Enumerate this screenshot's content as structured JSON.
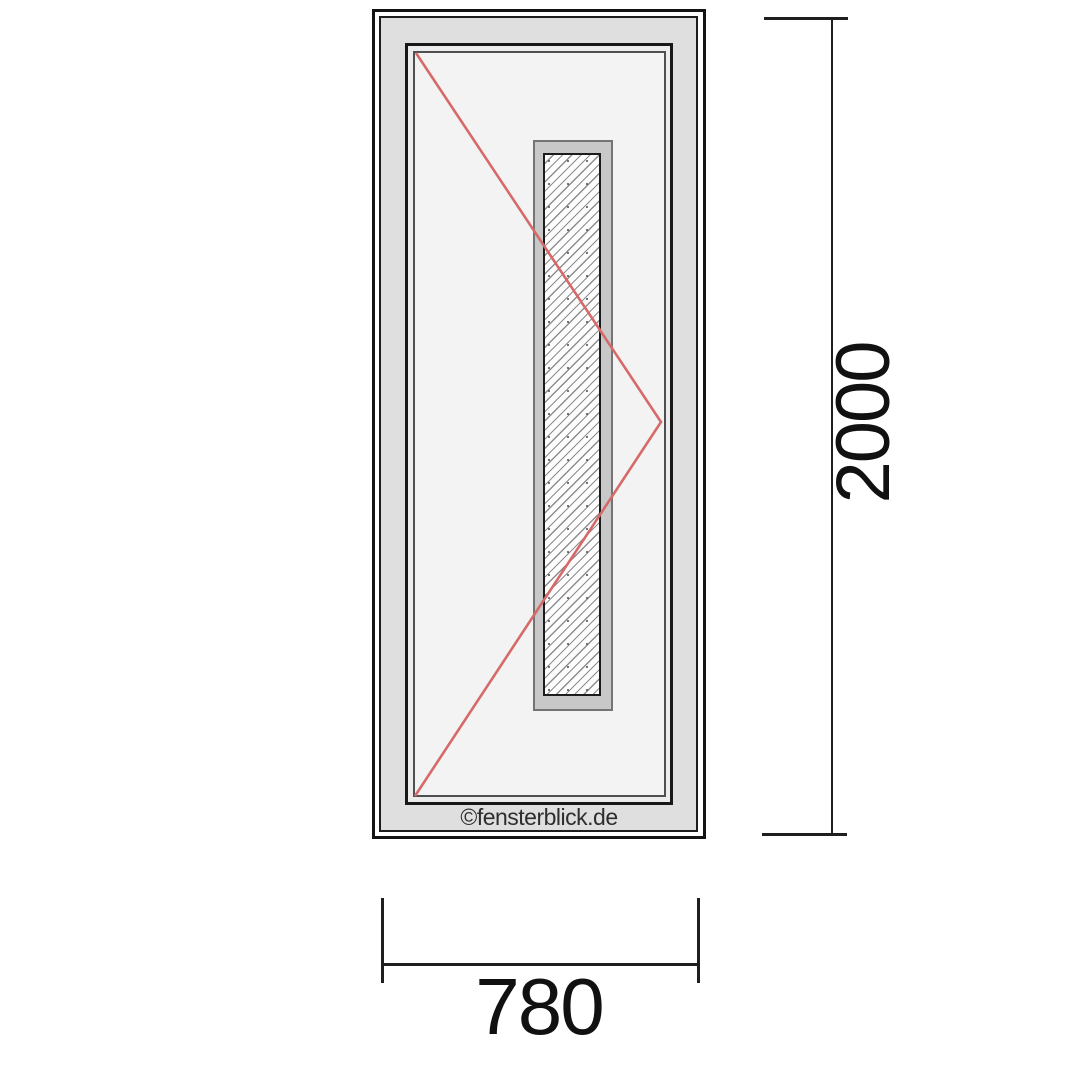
{
  "diagram": {
    "kind": "door-elevation-technical-drawing",
    "watermark": "©fensterblick.de",
    "opening_line_color": "#d66a6a",
    "glass_panel": "vertical-hatched-glazing"
  },
  "dimensions": {
    "height_label": "2000",
    "width_label": "780"
  },
  "colors": {
    "outline": "#141414",
    "frame_face": "#dfdfdf",
    "sash_face": "#ececec",
    "leaf_face": "#f3f3f3",
    "glazing_bead": "#c8c8c8",
    "glass_background": "#fdfdfd",
    "hatch_line": "#8d8d8d",
    "dimension_ink": "#1f1f1f",
    "opening_direction": "#d66a6a"
  }
}
